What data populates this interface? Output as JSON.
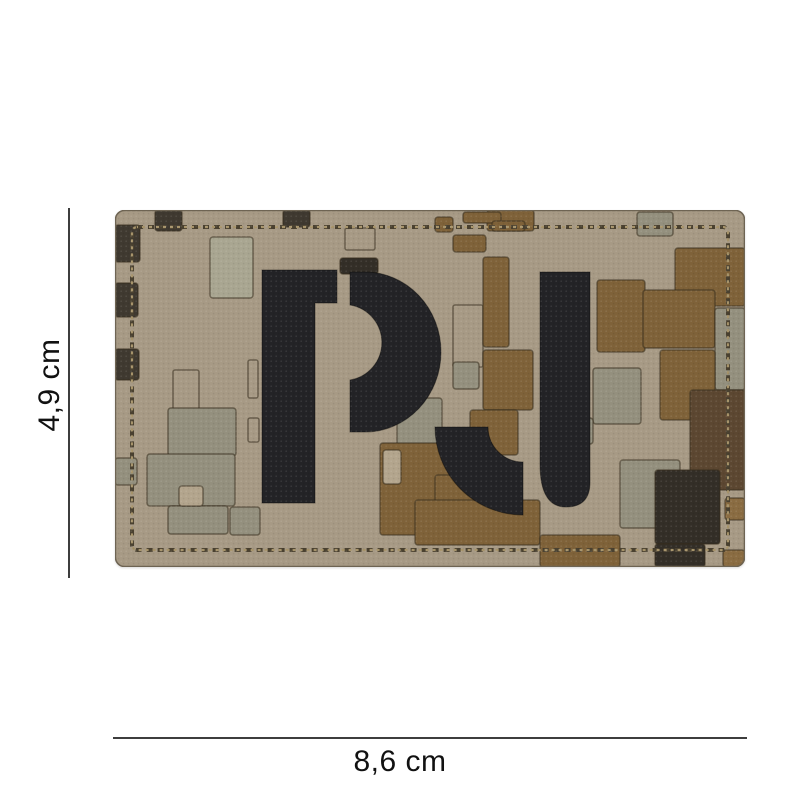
{
  "page": {
    "background": "#ffffff"
  },
  "product": {
    "type": "pvc-camo-patch-product-photo",
    "letters": "PJ",
    "dimensions": {
      "height_label": "4,9 cm",
      "width_label": "8,6 cm"
    },
    "patch": {
      "colors": {
        "base": "#a79a85",
        "brown": "#7f6239",
        "brown2": "#8a6c42",
        "darkbrown": "#5c4731",
        "sage": "#94907e",
        "lightsage": "#a9a691",
        "tan2": "#b3a58d",
        "dark": "#3f3930",
        "dark2": "#332e27",
        "letter": "#232326",
        "stitch_dark": "#4a4130",
        "stitch_gold": "#a7946b",
        "groove": "rgba(55,45,30,0.55)",
        "edge": "#6e6453",
        "dim_line": "#3d3d3d",
        "label": "#111111"
      },
      "camo_blocks": [
        {
          "x": 40,
          "y": 0,
          "w": 27,
          "h": 21,
          "c": "dark"
        },
        {
          "x": 168,
          "y": 0,
          "w": 27,
          "h": 17,
          "c": "dark"
        },
        {
          "x": 372,
          "y": 0,
          "w": 47,
          "h": 21,
          "c": "brown"
        },
        {
          "x": 348,
          "y": 2,
          "w": 38,
          "h": 11,
          "c": "brown"
        },
        {
          "x": 320,
          "y": 7,
          "w": 18,
          "h": 15,
          "c": "brown"
        },
        {
          "x": 377,
          "y": 11,
          "w": 33,
          "h": 10,
          "c": "brown"
        },
        {
          "x": 338,
          "y": 25,
          "w": 33,
          "h": 17,
          "c": "brown"
        },
        {
          "x": 522,
          "y": 2,
          "w": 36,
          "h": 24,
          "c": "sage"
        },
        {
          "x": 0,
          "y": 15,
          "w": 25,
          "h": 37,
          "c": "dark"
        },
        {
          "x": 0,
          "y": 73,
          "w": 23,
          "h": 34,
          "c": "dark"
        },
        {
          "x": 0,
          "y": 139,
          "w": 24,
          "h": 31,
          "c": "dark"
        },
        {
          "x": 0,
          "y": 248,
          "w": 22,
          "h": 27,
          "c": "sage"
        },
        {
          "x": 95,
          "y": 27,
          "w": 43,
          "h": 61,
          "c": "lightsage"
        },
        {
          "x": 368,
          "y": 47,
          "w": 26,
          "h": 90,
          "c": "brown"
        },
        {
          "x": 225,
          "y": 48,
          "w": 38,
          "h": 16,
          "c": "dark2"
        },
        {
          "x": 482,
          "y": 70,
          "w": 48,
          "h": 72,
          "c": "brown"
        },
        {
          "x": 560,
          "y": 38,
          "w": 70,
          "h": 58,
          "c": "brown"
        },
        {
          "x": 528,
          "y": 80,
          "w": 72,
          "h": 58,
          "c": "brown"
        },
        {
          "x": 600,
          "y": 98,
          "w": 30,
          "h": 82,
          "c": "sage"
        },
        {
          "x": 545,
          "y": 140,
          "w": 55,
          "h": 70,
          "c": "brown"
        },
        {
          "x": 575,
          "y": 180,
          "w": 55,
          "h": 100,
          "c": "darkbrown"
        },
        {
          "x": 478,
          "y": 158,
          "w": 48,
          "h": 56,
          "c": "sage"
        },
        {
          "x": 338,
          "y": 152,
          "w": 26,
          "h": 27,
          "c": "sage"
        },
        {
          "x": 368,
          "y": 140,
          "w": 50,
          "h": 60,
          "c": "brown"
        },
        {
          "x": 355,
          "y": 200,
          "w": 48,
          "h": 45,
          "c": "brown"
        },
        {
          "x": 282,
          "y": 188,
          "w": 45,
          "h": 50,
          "c": "sage"
        },
        {
          "x": 448,
          "y": 208,
          "w": 30,
          "h": 26,
          "c": "sage"
        },
        {
          "x": 53,
          "y": 198,
          "w": 68,
          "h": 48,
          "c": "sage"
        },
        {
          "x": 32,
          "y": 244,
          "w": 88,
          "h": 52,
          "c": "sage"
        },
        {
          "x": 53,
          "y": 296,
          "w": 60,
          "h": 28,
          "c": "sage"
        },
        {
          "x": 64,
          "y": 276,
          "w": 24,
          "h": 20,
          "c": "tan2"
        },
        {
          "x": 115,
          "y": 297,
          "w": 30,
          "h": 28,
          "c": "sage"
        },
        {
          "x": 265,
          "y": 233,
          "w": 72,
          "h": 92,
          "c": "brown"
        },
        {
          "x": 268,
          "y": 240,
          "w": 18,
          "h": 34,
          "c": "tan2"
        },
        {
          "x": 320,
          "y": 265,
          "w": 60,
          "h": 40,
          "c": "brown"
        },
        {
          "x": 300,
          "y": 290,
          "w": 125,
          "h": 45,
          "c": "brown"
        },
        {
          "x": 425,
          "y": 325,
          "w": 80,
          "h": 32,
          "c": "brown"
        },
        {
          "x": 505,
          "y": 250,
          "w": 60,
          "h": 68,
          "c": "sage"
        },
        {
          "x": 540,
          "y": 260,
          "w": 65,
          "h": 74,
          "c": "dark2"
        },
        {
          "x": 540,
          "y": 334,
          "w": 50,
          "h": 23,
          "c": "dark2"
        },
        {
          "x": 610,
          "y": 288,
          "w": 20,
          "h": 22,
          "c": "brown2"
        },
        {
          "x": 608,
          "y": 340,
          "w": 22,
          "h": 17,
          "c": "brown2"
        }
      ],
      "outline_blocks": [
        {
          "x": 133,
          "y": 150,
          "w": 10,
          "h": 38
        },
        {
          "x": 133,
          "y": 208,
          "w": 11,
          "h": 24
        },
        {
          "x": 338,
          "y": 95,
          "w": 30,
          "h": 62
        },
        {
          "x": 58,
          "y": 160,
          "w": 26,
          "h": 58
        },
        {
          "x": 230,
          "y": 18,
          "w": 30,
          "h": 22
        }
      ],
      "letter_paths": [
        "M147,60 H222 V93 H200 V293 H147 Z",
        "M235,62 H250 A76,80 0 0 1 250,222 H235 V170 A38,38 0 0 0 235,95 Z",
        "M425,62 H475 V272 Q475,297 451,297 Q425,297 425,254 Z",
        "M320,217 A88,88 0 0 0 408,305 V252 A35,35 0 0 1 373,217 Z"
      ]
    }
  }
}
